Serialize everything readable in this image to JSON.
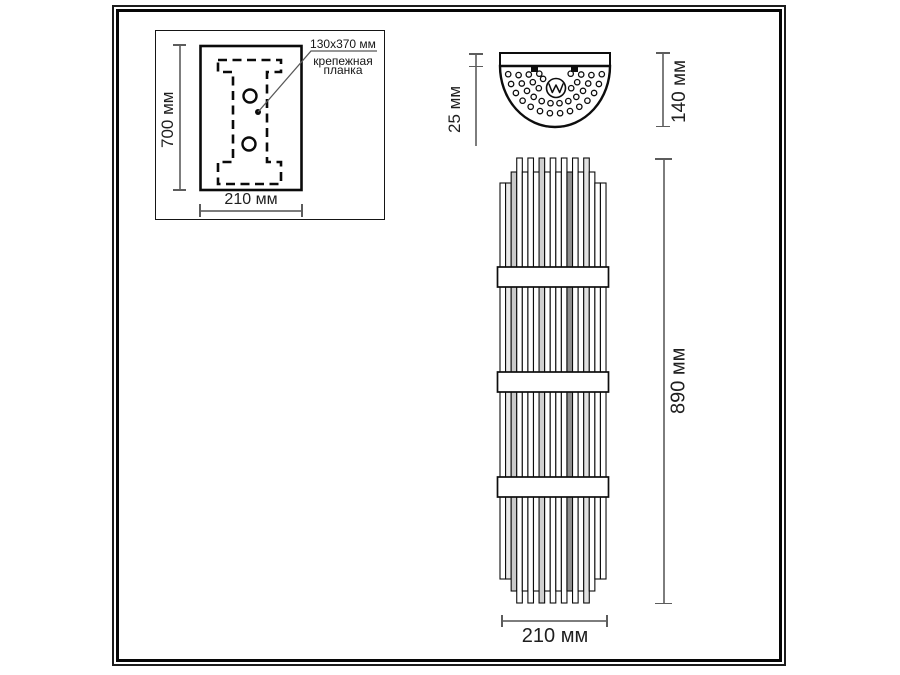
{
  "drawing_title": "wall-sconce-dimension-drawing",
  "inset": {
    "height_dim": "700 мм",
    "width_dim": "210 мм",
    "callout_size": "130x370 мм",
    "callout_name_line1": "крепежная",
    "callout_name_line2": "планка"
  },
  "top_view": {
    "plate_depth_dim": "25 мм",
    "total_depth_dim": "140 мм"
  },
  "front_view": {
    "height_dim": "890 мм",
    "width_dim": "210 мм"
  },
  "colors": {
    "line": "#0d0d0d",
    "dim_line": "#7d7d7d",
    "text": "#1a1a1a",
    "background": "#ffffff"
  }
}
